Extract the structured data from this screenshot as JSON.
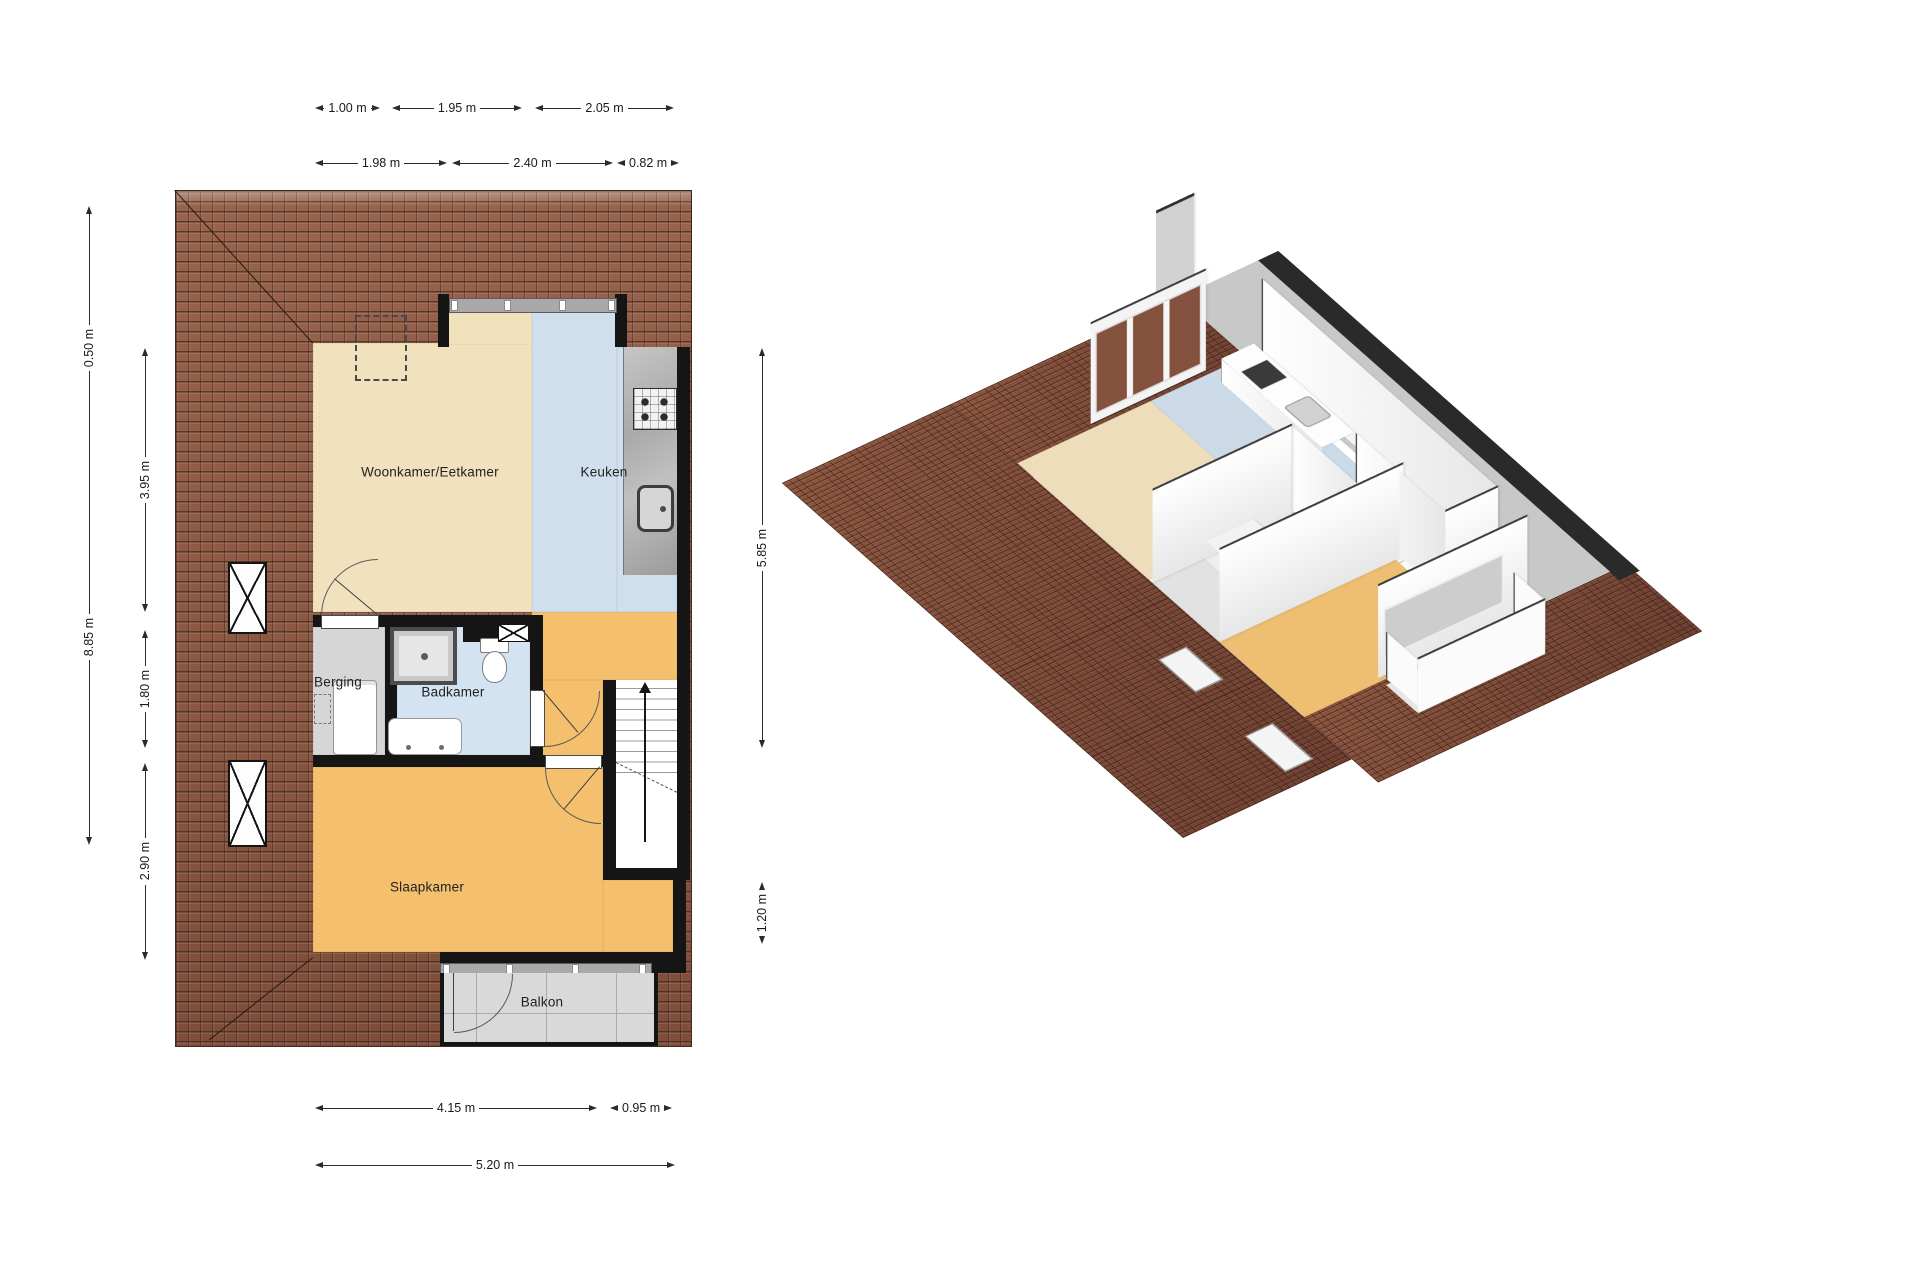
{
  "view_2d": {
    "rooms": {
      "living": "Woonkamer/Eetkamer",
      "kitchen": "Keuken",
      "storage": "Berging",
      "bathroom": "Badkamer",
      "bedroom": "Slaapkamer",
      "balcony": "Balkon"
    },
    "dimensions": {
      "top_row_1": {
        "a": "1.00 m",
        "b": "1.95 m",
        "c": "2.05 m"
      },
      "top_row_2": {
        "a": "1.98 m",
        "b": "2.40 m",
        "c": "0.82 m"
      },
      "left_outer": {
        "a": "0.50 m",
        "b": "8.85 m"
      },
      "left_inner": {
        "a": "3.95 m",
        "b": "1.80 m",
        "c": "2.90 m"
      },
      "right_side": {
        "a": "5.85 m",
        "b": "1.20 m"
      },
      "bottom_row_1": {
        "a": "4.15 m",
        "b": "0.95 m"
      },
      "bottom_row_2": {
        "a": "5.20 m"
      }
    }
  },
  "icons": {
    "roof_window_icon": "☒",
    "vent_icon": "☒",
    "stairs_up_arrow_icon": "▲"
  },
  "colors": {
    "roof": "#8a5743",
    "living_floor": "#f2e1bd",
    "kitchen_bathroom_floor": "#cfdfee",
    "bedroom_hall_floor": "#f5c06e",
    "storage_floor": "#d6d6d6",
    "balcony_floor": "#d9d9d9",
    "wall": "#151515"
  }
}
